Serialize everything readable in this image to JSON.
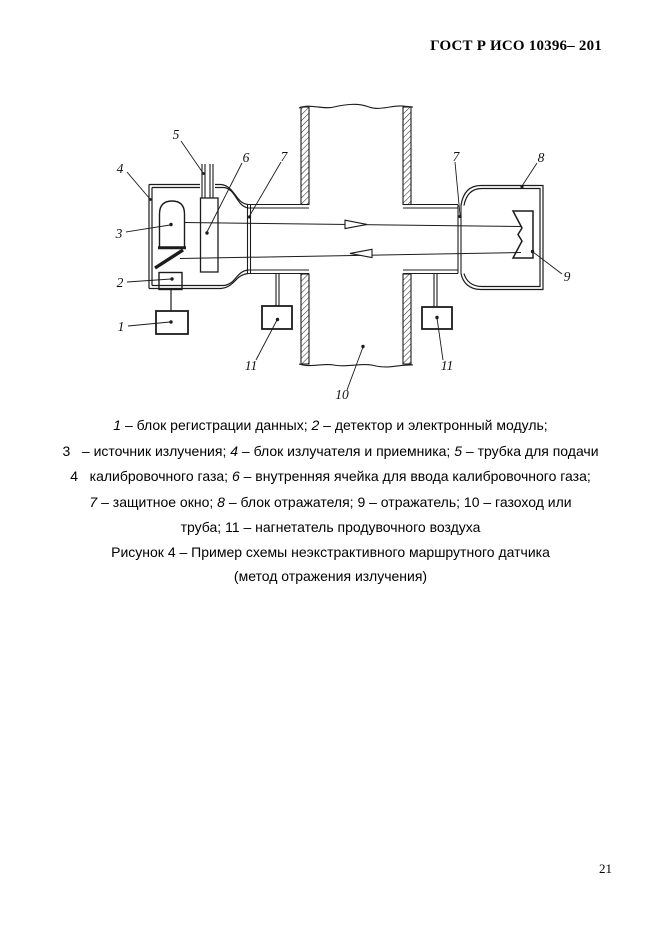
{
  "header": {
    "title": "ГОСТ Р ИСО 10396– 201"
  },
  "figure": {
    "labels": {
      "l1": "1",
      "l2": "2",
      "l3": "3",
      "l4": "4",
      "l5": "5",
      "l6": "6",
      "l7l": "7",
      "l7r": "7",
      "l8": "8",
      "l9": "9",
      "l10": "10",
      "l11l": "11",
      "l11r": "11"
    }
  },
  "legend": {
    "lines": [
      [
        {
          "t": "1",
          "i": true
        },
        {
          "t": " – блок регистрации данных; "
        },
        {
          "t": "2",
          "i": true
        },
        {
          "t": " – детектор и электронный модуль;"
        }
      ],
      [
        {
          "t": "3   – источник излучения; "
        },
        {
          "t": "4",
          "i": true
        },
        {
          "t": " – блок излучателя и приемника; "
        },
        {
          "t": "5",
          "i": true
        },
        {
          "t": " – трубка для подачи"
        }
      ],
      [
        {
          "t": "4   калибровочного газа; "
        },
        {
          "t": "6",
          "i": true
        },
        {
          "t": " – внутренняя ячейка для ввода калибровочного газа;"
        }
      ],
      [
        {
          "t": "7",
          "i": true
        },
        {
          "t": " – защитное окно; "
        },
        {
          "t": "8",
          "i": true
        },
        {
          "t": " – блок отражателя; 9 – отражатель; 10 – газоход или"
        }
      ],
      [
        {
          "t": "труба; 11 – нагнетатель продувочного воздуха"
        }
      ]
    ]
  },
  "caption": {
    "line1": "Рисунок 4 – Пример схемы неэкстрактивного маршрутного датчика",
    "line2": "(метод отражения излучения)"
  },
  "footer": {
    "page_number": "21"
  }
}
